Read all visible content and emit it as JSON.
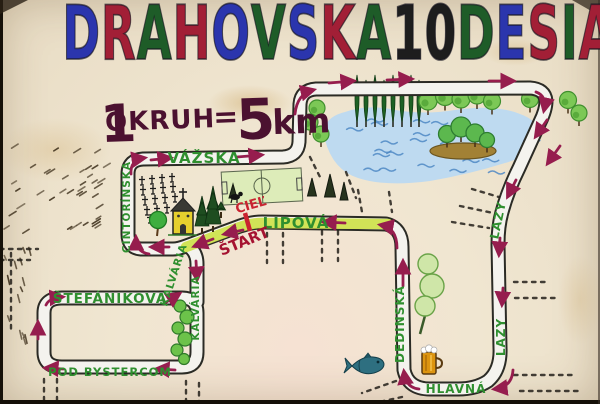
{
  "title": {
    "text": "DRAHOVSKÁ 10 DESIATKA",
    "letters": [
      {
        "ch": "D",
        "color": "#2b35ad"
      },
      {
        "ch": "R",
        "color": "#a21f36"
      },
      {
        "ch": "A",
        "color": "#1e5c28"
      },
      {
        "ch": "H",
        "color": "#a21f36"
      },
      {
        "ch": "O",
        "color": "#2b35ad"
      },
      {
        "ch": "V",
        "color": "#1e5c28"
      },
      {
        "ch": "S",
        "color": "#2b35ad"
      },
      {
        "ch": "K",
        "color": "#a21f36"
      },
      {
        "ch": "Á",
        "color": "#1e5c28"
      },
      {
        "ch": "1",
        "color": "#1d1d1d"
      },
      {
        "ch": "0",
        "color": "#1d1d1d"
      },
      {
        "ch": "D",
        "color": "#1e5c28"
      },
      {
        "ch": "E",
        "color": "#2b35ad"
      },
      {
        "ch": "S",
        "color": "#a21f36"
      },
      {
        "ch": "I",
        "color": "#1e5c28"
      },
      {
        "ch": "A",
        "color": "#a21f36"
      },
      {
        "ch": "T",
        "color": "#2b35ad"
      },
      {
        "ch": "K",
        "color": "#1e5c28"
      },
      {
        "ch": "A",
        "color": "#2b35ad"
      }
    ]
  },
  "subtitle": {
    "lap_count": "1",
    "lap_label": "OKRUH",
    "equals": "=",
    "distance": "5",
    "unit": "km"
  },
  "map": {
    "streets": {
      "vazska": "VÁŽSKA",
      "cintorinska": "CINTORÍNSKA",
      "lipova": "LIPOVÁ",
      "stefanikova": "ŠTEFÁNIKOVA",
      "pod_bystercom": "POD BYSTERCOM",
      "kalvaria": "KALVÁRIA",
      "dedinska": "DEDINSKÁ",
      "lazy": "LAZY",
      "hlavna": "HLAVNÁ"
    },
    "start_label": "ŠTART",
    "finish_label": "CIEĽ"
  },
  "colors": {
    "road_outline": "#2b2b25",
    "road_fill": "#f4f3ee",
    "route_highlight": "#cfe14e",
    "street_green": "#2f8f2f",
    "arrow_maroon": "#961d4e",
    "start_red": "#a51231",
    "finish_red": "#c92330",
    "subtitle_plum": "#4b1130",
    "lake_blue": "#bedaf0",
    "wave_blue": "#4f88c4",
    "field_green": "#dcedb8",
    "tree_dark": "#1d6124",
    "tree_light": "#7cc856",
    "church_yellow": "#e6cf2e",
    "beer_amber": "#dc9410",
    "fish_teal": "#2e6f80"
  }
}
